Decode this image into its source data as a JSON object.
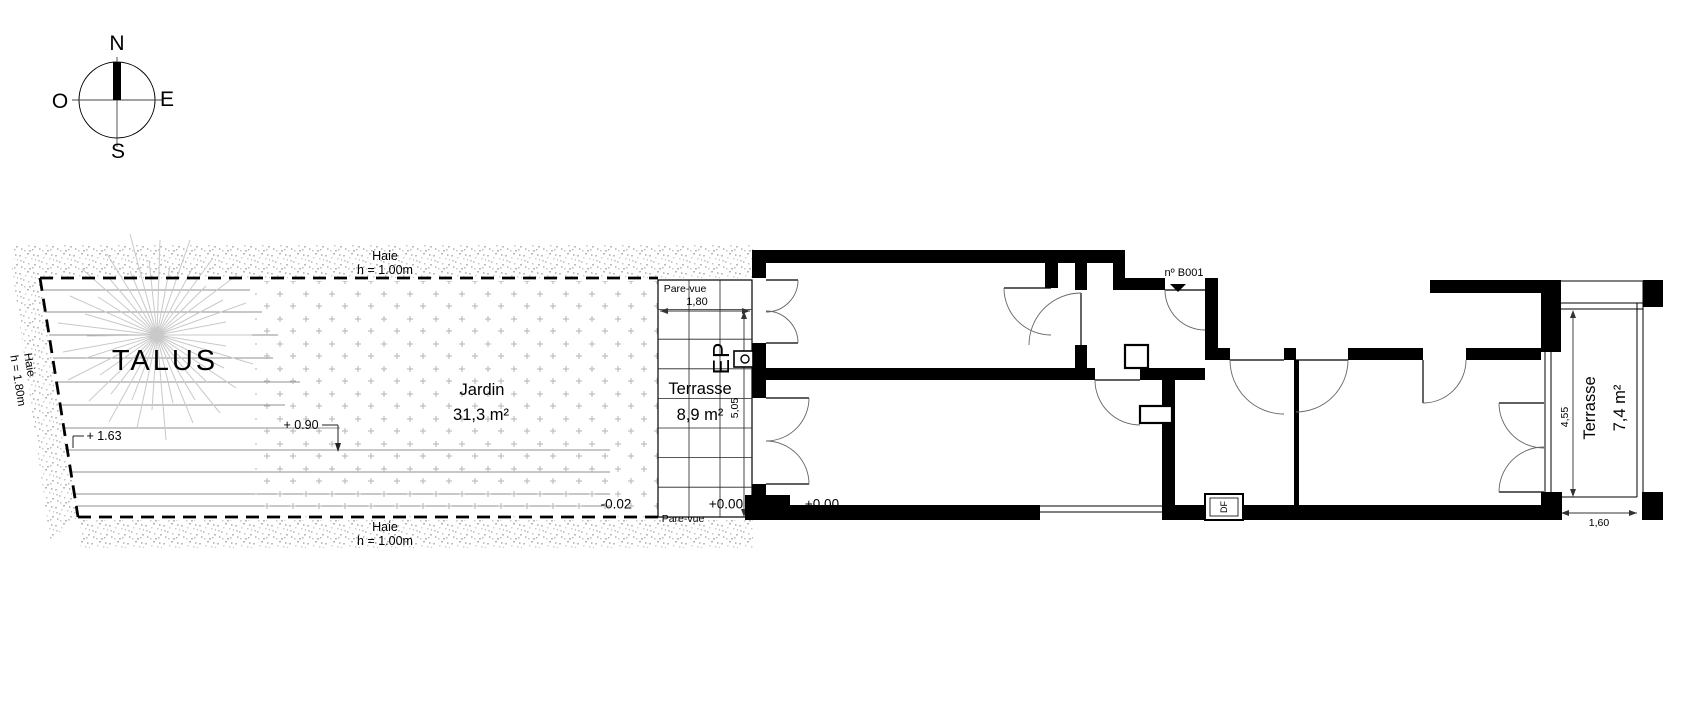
{
  "compass": {
    "n": "N",
    "e": "E",
    "s": "S",
    "o": "O"
  },
  "site": {
    "hedge_top": {
      "name": "Haie",
      "height": "h = 1.00m"
    },
    "hedge_bottom": {
      "name": "Haie",
      "height": "h = 1.00m"
    },
    "hedge_left": {
      "name": "Haie",
      "height": "h = 1.80m"
    },
    "talus": {
      "label": "TALUS",
      "level_upper": "+ 1.63",
      "level_lower": "+ 0.90"
    },
    "garden": {
      "name": "Jardin",
      "area": "31,3 m²",
      "level": "-0.02"
    }
  },
  "terrace_west": {
    "name": "Terrasse",
    "area": "8,9 m²",
    "level": "+0.00",
    "screen_top": "Pare-vue",
    "screen_bottom": "Pare-vue",
    "width": "1,80",
    "depth": "5,05",
    "downpipe": "EP"
  },
  "building": {
    "entrance": "nº B001",
    "level": "+0.00",
    "vent": "DF"
  },
  "terrace_east": {
    "name": "Terrasse",
    "area": "7,4 m²",
    "depth": "4,55",
    "width": "1,60"
  }
}
